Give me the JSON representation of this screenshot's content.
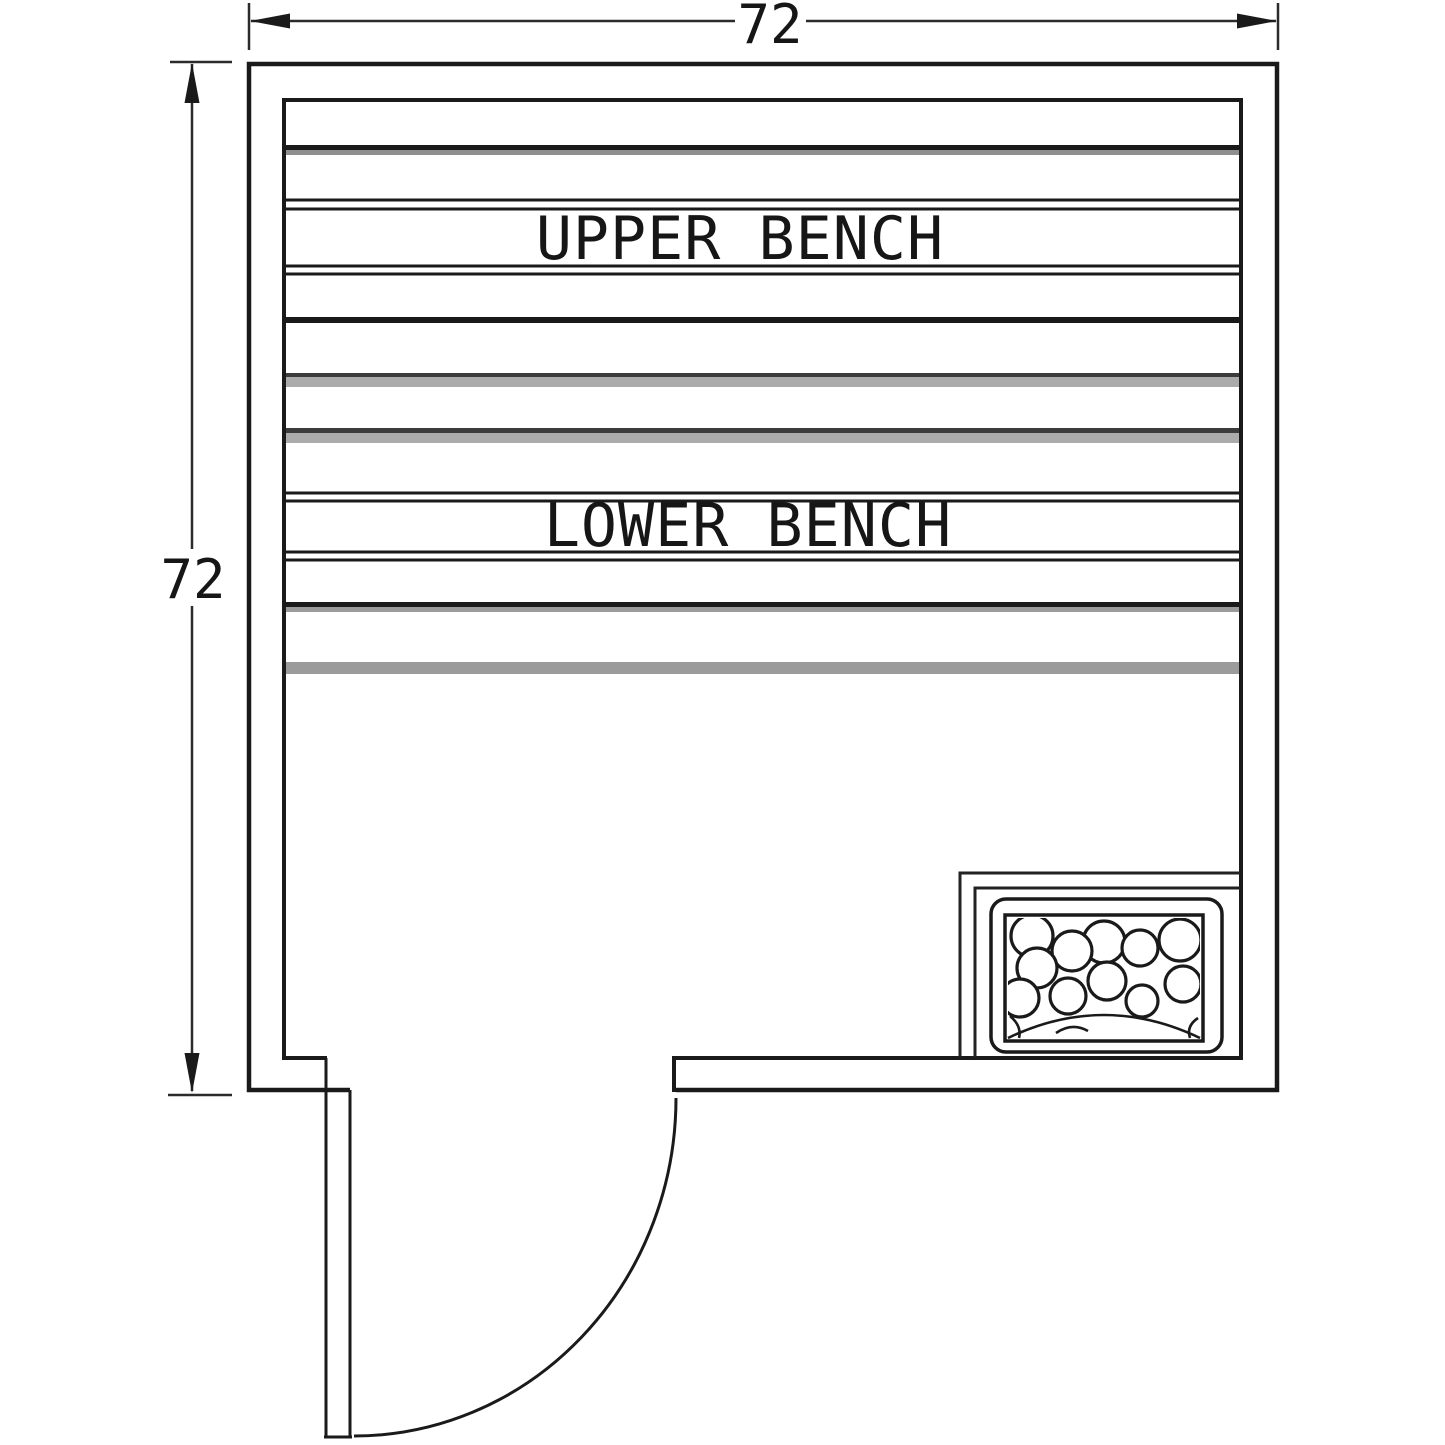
{
  "drawing": {
    "dimensions": {
      "top": "72",
      "left": "72"
    },
    "benches": {
      "upper": "UPPER BENCH",
      "lower": "LOWER BENCH"
    },
    "colors": {
      "line": "#1a1a1a",
      "gray_slat": "#9b9b9b",
      "dark_slat": "#3c3c3c",
      "background": "#ffffff"
    }
  }
}
